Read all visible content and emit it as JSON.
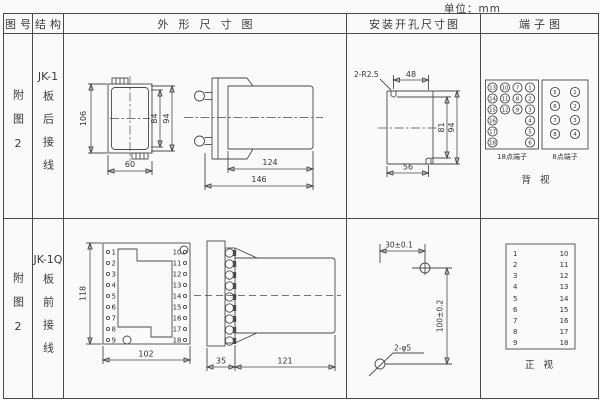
{
  "unit_label": "单位：mm",
  "header": {
    "fig": "图号",
    "structure": "结构",
    "outline": "外形尺寸图",
    "install": "安装开孔尺寸图",
    "terminal": "端子图"
  },
  "row1": {
    "fig_no": "附图2",
    "model": "JK-1",
    "wiring": "板后接线",
    "outline": {
      "d106": "106",
      "d84": "84",
      "d94": "94",
      "d60": "60",
      "d124": "124",
      "d146": "146"
    },
    "install": {
      "radius_label": "2-R2.5",
      "d48": "48",
      "d81": "81",
      "d94": "94",
      "d56": "56"
    },
    "terminal": {
      "t18": [
        "13",
        "10",
        "7",
        "1",
        "14",
        "11",
        "8",
        "2",
        "15",
        "12",
        "9",
        "3",
        "16",
        "4",
        "17",
        "5",
        "18",
        "6"
      ],
      "t8": [
        "5",
        "1",
        "6",
        "2",
        "7",
        "3",
        "8",
        "4"
      ],
      "label18": "18点端子",
      "label8": "8点端子",
      "view": "背 视"
    }
  },
  "row2": {
    "fig_no": "附图2",
    "model": "JK-1Q",
    "wiring": "板前接线",
    "outline": {
      "d118": "118",
      "d102": "102",
      "d35": "35",
      "d121": "121",
      "pins_left": [
        "1",
        "2",
        "3",
        "4",
        "5",
        "6",
        "7",
        "8",
        "9"
      ],
      "pins_right": [
        "10",
        "11",
        "12",
        "13",
        "14",
        "15",
        "16",
        "17",
        "18"
      ]
    },
    "install": {
      "d30": "30±0.1",
      "d100": "100±0.2",
      "hole_label": "2-φ5"
    },
    "terminal": {
      "left": [
        "1",
        "2",
        "3",
        "4",
        "5",
        "6",
        "7",
        "8",
        "9"
      ],
      "right": [
        "10",
        "11",
        "12",
        "13",
        "14",
        "15",
        "16",
        "17",
        "18"
      ],
      "view": "正 视"
    }
  }
}
